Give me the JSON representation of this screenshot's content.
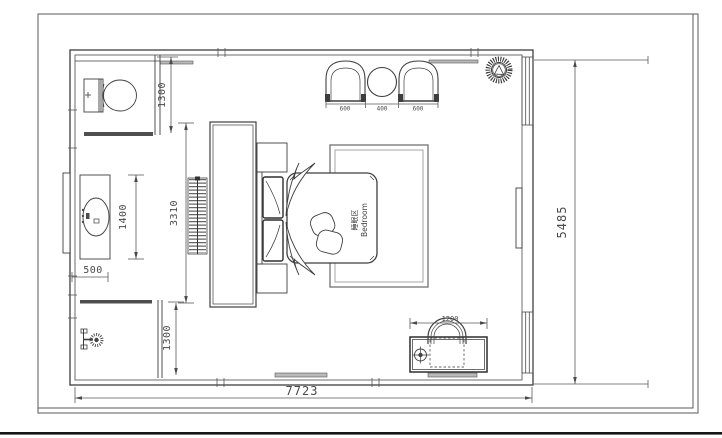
{
  "drawing": {
    "room_label_cn": "睡眠区",
    "room_label_en": "Bedroom",
    "dims": {
      "overall_width": "7723",
      "overall_height": "5485",
      "toilet_depth": "1300",
      "shower_depth": "1300",
      "vanity_length": "1400",
      "vanity_width": "500",
      "tv_wall": "3310",
      "armchair_left": "600",
      "tea_table": "400",
      "armchair_right": "600",
      "desk_width": "1200"
    },
    "colors": {
      "ink": "#3f3f3f",
      "ink_light": "#777777",
      "dim_text": "#4a4a4a",
      "wall_fill": "#4f4f4f",
      "paper": "#ffffff"
    }
  }
}
